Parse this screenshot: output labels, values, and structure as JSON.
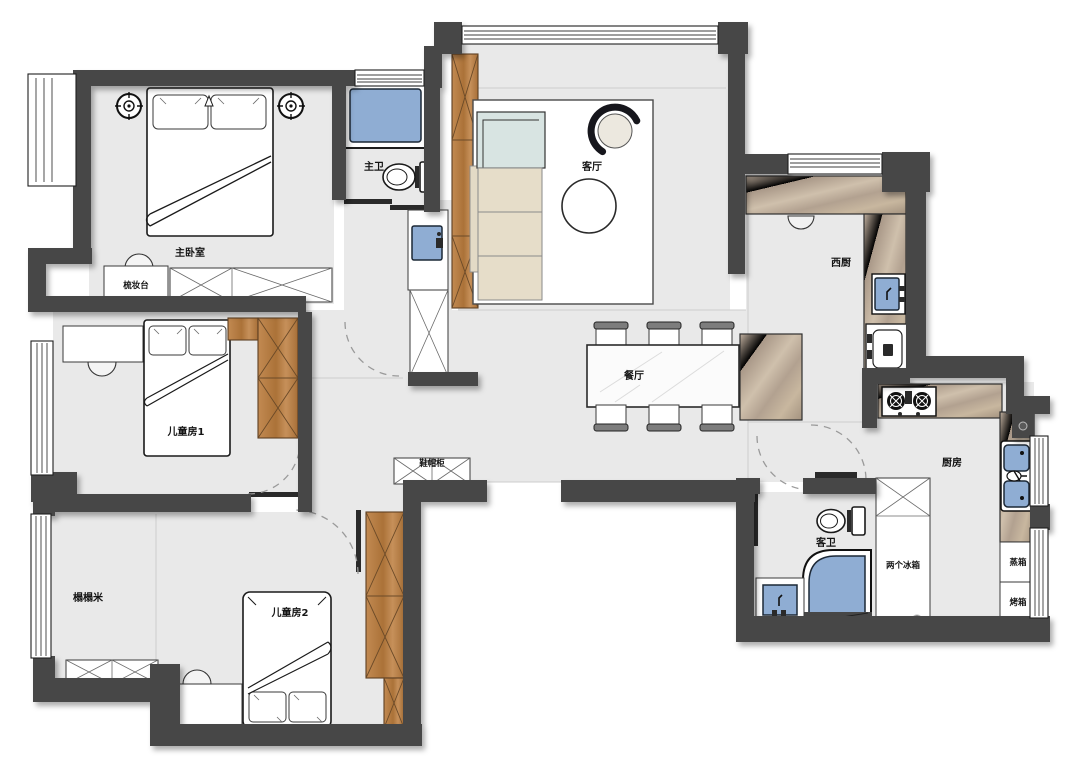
{
  "plan": {
    "labels": {
      "master_bedroom": "主卧室",
      "dresser": "梳妆台",
      "master_bath": "主卫",
      "living_room": "客厅",
      "west_kitchen": "西厨",
      "dining_room": "餐厅",
      "kitchen": "厨房",
      "guest_bath": "客卫",
      "two_fridges": "两个冰箱",
      "steam_oven": "蒸箱",
      "oven": "烤箱",
      "kids_room_1": "儿童房1",
      "kids_room_2": "儿童房2",
      "tatami": "榻榻米",
      "shoe_cabinet": "鞋帽柜"
    },
    "colors": {
      "wall": "#474747",
      "floor": "#e9e9e9",
      "wood_cabinet": "#b9824d",
      "water_fixture": "#8fadd3",
      "stone_counter": "#b7a694",
      "outline": "#1a1a1a"
    }
  }
}
